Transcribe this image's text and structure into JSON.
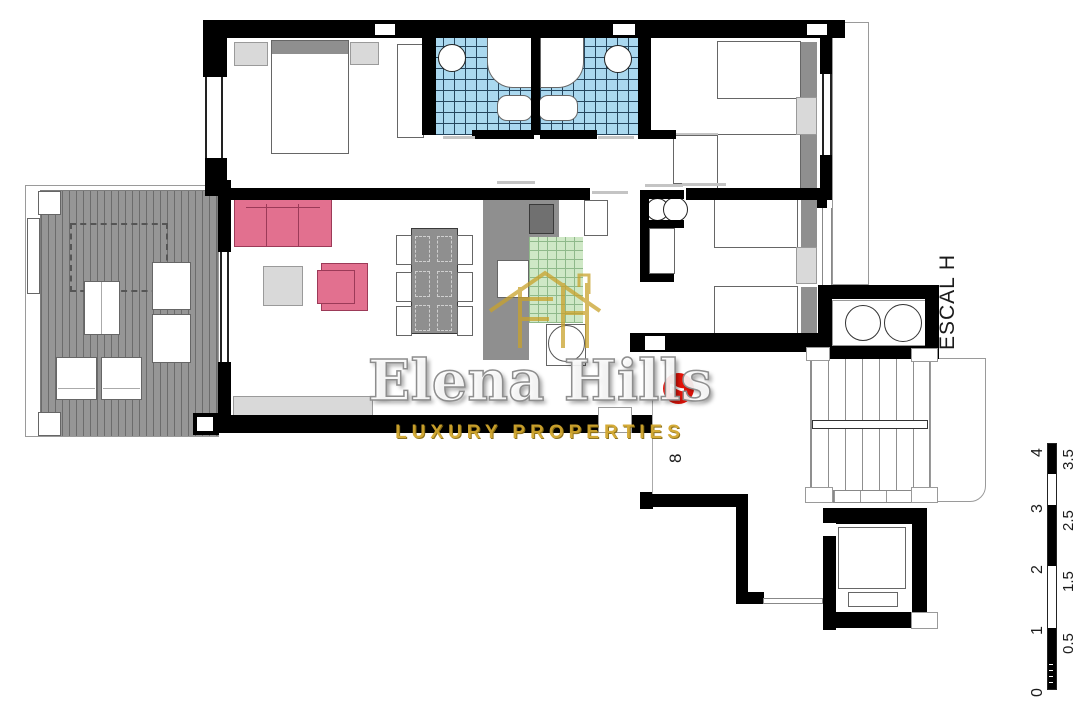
{
  "labels": {
    "stairwell": "ESCAL H",
    "unit_badge": "7",
    "neighbor_unit": "8"
  },
  "watermark": {
    "brand": "Elena Hills",
    "tagline": "LUXURY PROPERTIES"
  },
  "scale_bar": {
    "left": [
      "4",
      "3",
      "2",
      "1",
      "0"
    ],
    "right": [
      "3.5",
      "2.5",
      "1.5",
      "0.5"
    ]
  },
  "colors": {
    "wall": "#000000",
    "tile_blue": "#aad8ef",
    "tile_line": "#24455d",
    "tile_green": "#cfe8c6",
    "tile_green_line": "#8fb98a",
    "sofa_pink": "#e2708f",
    "sofa_border": "#9c3a58",
    "deck_gray": "#969696",
    "deck_stripe": "#6c6c6c",
    "counter_gray": "#8f8f8f",
    "light_gray": "#d9d9d9",
    "headboard_gray": "#8f8f8f",
    "red_badge": "#e81309",
    "gold": "#d2a72e"
  }
}
